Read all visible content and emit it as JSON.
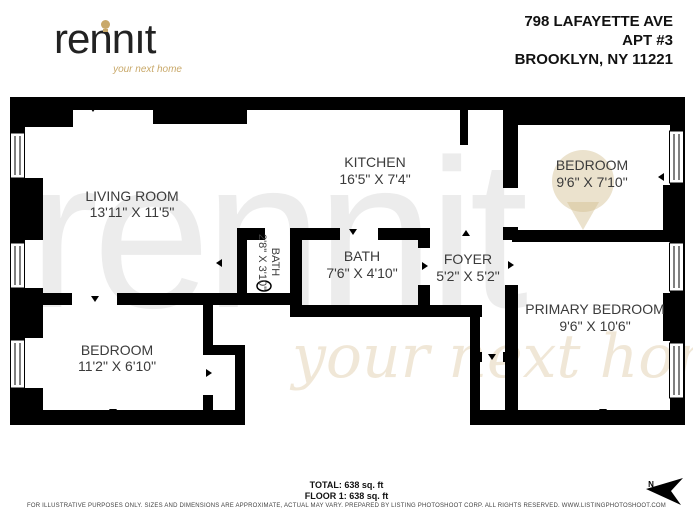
{
  "brand": {
    "logo_text": "rennit",
    "logo_parts": {
      "left": "renn",
      "i": "ı",
      "right": "t"
    },
    "tagline": "your next home",
    "accent_color": "#c9a96a"
  },
  "address": {
    "line1": "798 LAFAYETTE AVE",
    "line2": "APT #3",
    "line3": "BROOKLYN, NY 11221"
  },
  "rooms": {
    "living_room": {
      "name": "LIVING ROOM",
      "dims": "13'11\" X 11'5\""
    },
    "kitchen": {
      "name": "KITCHEN",
      "dims": "16'5\" X 7'4\""
    },
    "bedroom_top": {
      "name": "BEDROOM",
      "dims": "9'6\" X 7'10\""
    },
    "bath_small": {
      "name": "BATH",
      "dims": "2'8\" X 3'10\""
    },
    "bath": {
      "name": "BATH",
      "dims": "7'6\" X 4'10\""
    },
    "foyer": {
      "name": "FOYER",
      "dims": "5'2\" X 5'2\""
    },
    "primary_bedroom": {
      "name": "PRIMARY BEDROOM",
      "dims": "9'6\" X 10'6\""
    },
    "bedroom_bottom": {
      "name": "BEDROOM",
      "dims": "11'2\" X 6'10\""
    }
  },
  "summary": {
    "total": "TOTAL: 638 sq. ft",
    "floor1": "FLOOR 1: 638 sq. ft"
  },
  "disclaimer": "FOR ILLUSTRATIVE PURPOSES ONLY. SIZES AND DIMENSIONS ARE APPROXIMATE, ACTUAL MAY VARY. PREPARED BY LISTING PHOTOSHOOT CORP. ALL RIGHTS RESERVED. WWW.LISTINGPHOTOSHOOT.COM",
  "compass": {
    "label": "N"
  },
  "watermark": {
    "text": "rennit",
    "tagline": "your next home"
  }
}
